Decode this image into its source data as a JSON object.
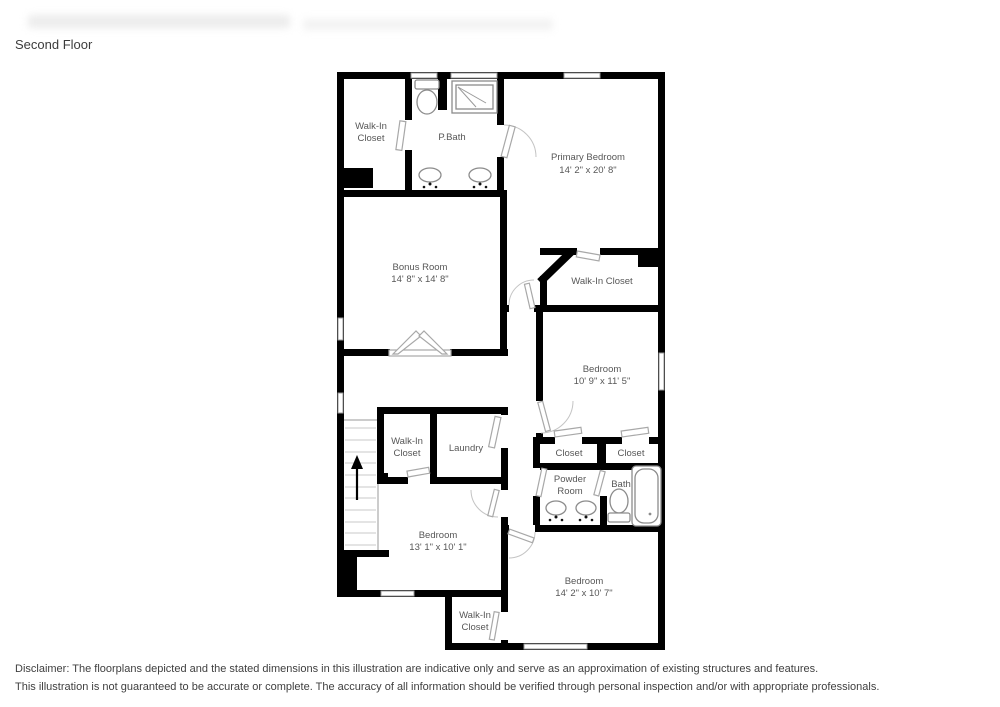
{
  "page": {
    "title": "Second Floor"
  },
  "rooms": {
    "wic_top": {
      "line1": "Walk-In",
      "line2": "Closet"
    },
    "pbath": {
      "name": "P.Bath"
    },
    "primary": {
      "name": "Primary Bedroom",
      "dims": "14' 2\" x 20' 8\""
    },
    "bonus": {
      "name": "Bonus Room",
      "dims": "14' 8\" x 14' 8\""
    },
    "wic_right": {
      "name": "Walk-In Closet"
    },
    "bedroom_right": {
      "name": "Bedroom",
      "dims": "10' 9\" x 11' 5\""
    },
    "wic_mid": {
      "line1": "Walk-In",
      "line2": "Closet"
    },
    "laundry": {
      "name": "Laundry"
    },
    "closet_left": {
      "name": "Closet"
    },
    "closet_right": {
      "name": "Closet"
    },
    "powder": {
      "line1": "Powder",
      "line2": "Room"
    },
    "bath": {
      "name": "Bath"
    },
    "bedroom_bl": {
      "name": "Bedroom",
      "dims": "13' 1\" x 10' 1\""
    },
    "wic_bottom": {
      "line1": "Walk-In",
      "line2": "Closet"
    },
    "bedroom_br": {
      "name": "Bedroom",
      "dims": "14' 2\" x 10' 7\""
    }
  },
  "disclaimer": {
    "line1": "Disclaimer: The floorplans depicted and the stated dimensions in this illustration are indicative only and serve as an approximation of existing structures and features.",
    "line2": "This illustration is not guaranteed to be accurate or complete. The accuracy of all information should be verified through personal inspection and/or with appropriate professionals."
  }
}
